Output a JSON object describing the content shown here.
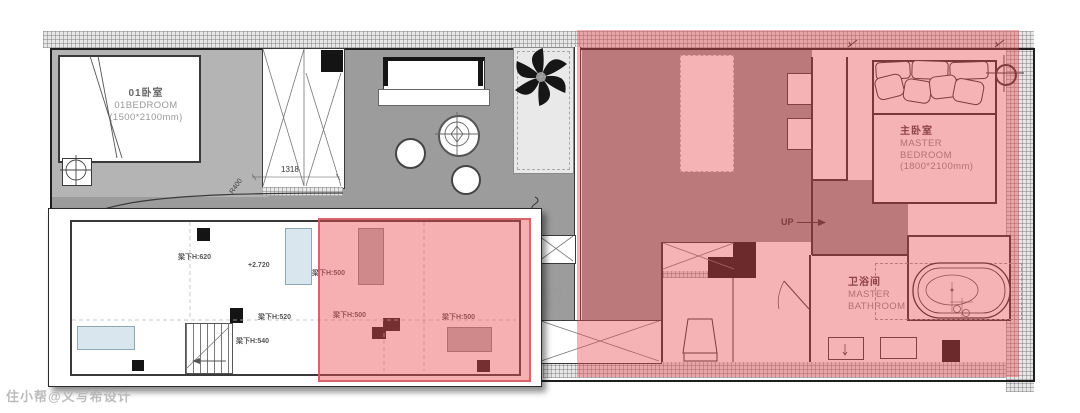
{
  "watermark": "住小帮@义写希设计",
  "rooms": {
    "bedroom01": {
      "name_zh": "01卧室",
      "name_en": "01BEDROOM",
      "size": "(1500*2100mm)"
    },
    "master_bedroom": {
      "name_zh": "主卧室",
      "en_line1": "MASTER",
      "en_line2": "BEDROOM",
      "size": "(1800*2100mm)"
    },
    "master_bathroom": {
      "name_zh": "卫浴间",
      "en_line1": "MASTER",
      "en_line2": "BATHROOM"
    },
    "walk_in_closet": {
      "en_line1": "WALK-IN",
      "en_line2": "CLOSET"
    }
  },
  "annotations": {
    "up": "UP",
    "dim_wardrobe": "1318",
    "dim_tub": "1500",
    "radius": "R400"
  },
  "inset": {
    "beam_620": "梁下H:620",
    "beam_520": "梁下H:520",
    "beam_540": "梁下H:540",
    "beam_500": "梁下H:500",
    "level": "+2.720"
  },
  "colors": {
    "highlight_overlay": "#e74a51",
    "inset_overlay": "#eb5055",
    "floor_gray": "#9c9c9c",
    "bedroom_floor_gray": "#b4b4b4",
    "window_blue": "#d9e6ee",
    "column_black": "#141414",
    "wall_hatch": "#e7e7e7"
  }
}
